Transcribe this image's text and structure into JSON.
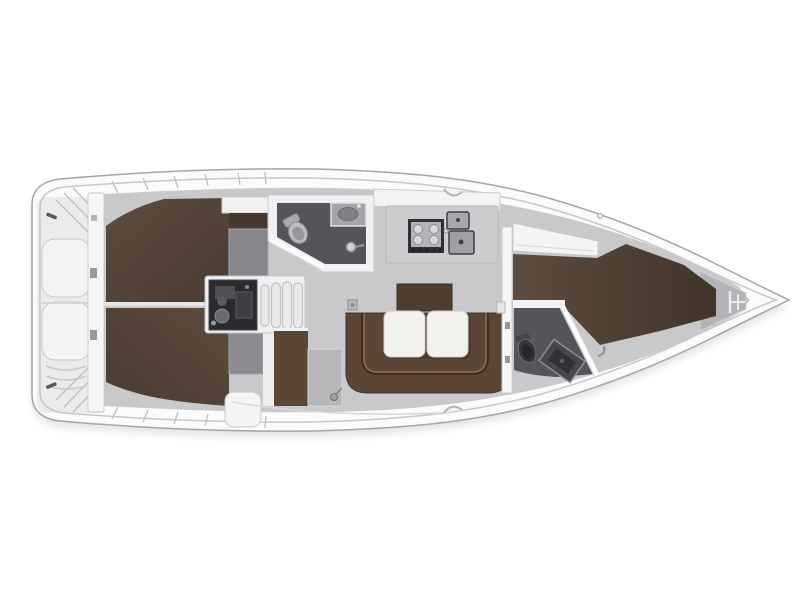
{
  "meta": {
    "title": "Sailing yacht interior deck plan",
    "type": "floor-plan",
    "orientation": "bow-right, stern-left",
    "visible_text": []
  },
  "colors": {
    "hull": "#fbfbfc",
    "hullStroke": "#a5a5a9",
    "deckLine": "#c7c7ca",
    "sternShade": "#ebebed",
    "sole": "#c9c9cb",
    "berthDark": "#4a3b31",
    "berthLight": "#5d4c3f",
    "settee": "#5b4636",
    "backrest": "#4e3d31",
    "wet": "#54545a",
    "counter": "#cdcdd0",
    "applianceDark": "#303034",
    "steel": "#a7a8ac",
    "engine": "#2b2b2f",
    "furnitureWhite": "#f4f4f6",
    "tableWhite": "#f3f2ef"
  },
  "regions": [
    {
      "id": "stern-platform",
      "desc": "transom with lockers and steps"
    },
    {
      "id": "aft-cabin-top",
      "desc": "aft double-berth cabin"
    },
    {
      "id": "aft-cabin-bottom",
      "desc": "aft double-berth cabin"
    },
    {
      "id": "engine-compartment",
      "desc": "engine block under companionway"
    },
    {
      "id": "companionway-steps",
      "desc": "entry steps"
    },
    {
      "id": "aft-heads",
      "desc": "bathroom with toilet, sink and shower"
    },
    {
      "id": "galley",
      "desc": "kitchen with stove and double sink"
    },
    {
      "id": "salon",
      "desc": "U-shaped settee with folding table"
    },
    {
      "id": "nav-area",
      "desc": "seat and locker beside companionway"
    },
    {
      "id": "fore-cabin",
      "desc": "forward V-berth cabin"
    },
    {
      "id": "fore-heads",
      "desc": "forward bathroom with toilet and sink"
    },
    {
      "id": "anchor-locker",
      "desc": "bow anchor locker"
    }
  ]
}
